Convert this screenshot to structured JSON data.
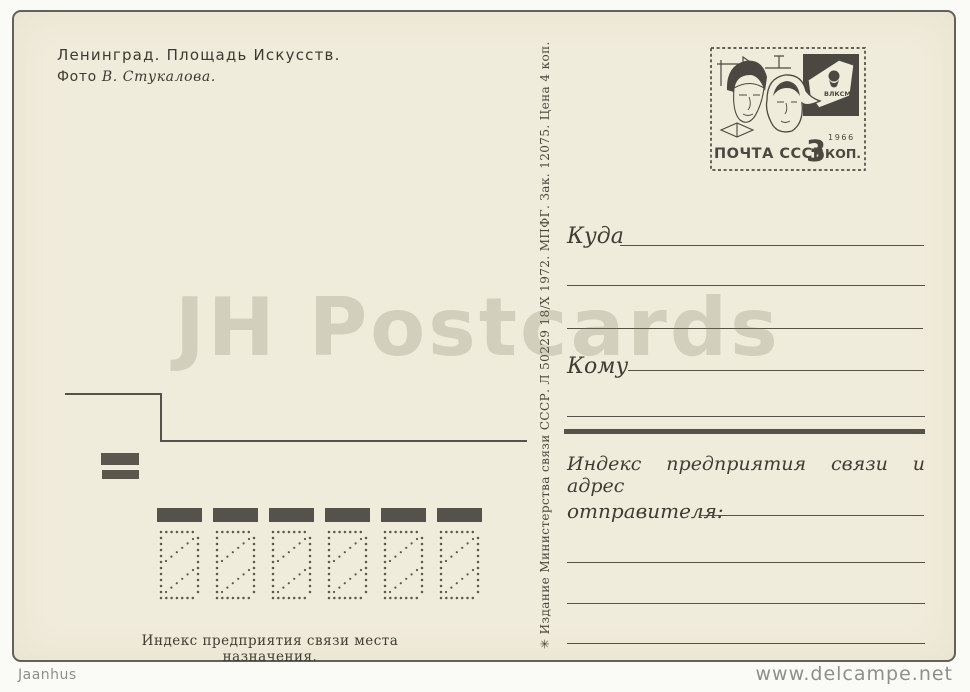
{
  "header": {
    "title": "Ленинград. Площадь Искусств.",
    "photo_prefix": "Фото",
    "photo_author": "В. Стукалова."
  },
  "stamp": {
    "post": "ПОЧТА СССР",
    "denomination": "3",
    "unit": "КОП.",
    "year": "1966",
    "badge": "ВЛКСМ"
  },
  "imprint": "✳ Издание Министерства связи СССР. Л 50229 18/X 1972. МПФГ. Зак. 12075. Цена 4 коп.",
  "address": {
    "to_label": "Куда",
    "name_label": "Кому",
    "sender_line1": "Индекс предприятия связи и адрес",
    "sender_line2": "отправителя:"
  },
  "index_caption": "Индекс предприятия связи места назначения.",
  "index_cells": 6,
  "watermark": "JH Postcards",
  "footer": {
    "seller": "Jaanhus",
    "site": "www.delcampe.net"
  },
  "colors": {
    "paper": "#f0ecdb",
    "ink": "#45423b",
    "line": "#55524a",
    "watermark_gray": "rgba(125,119,99,0.25)"
  }
}
